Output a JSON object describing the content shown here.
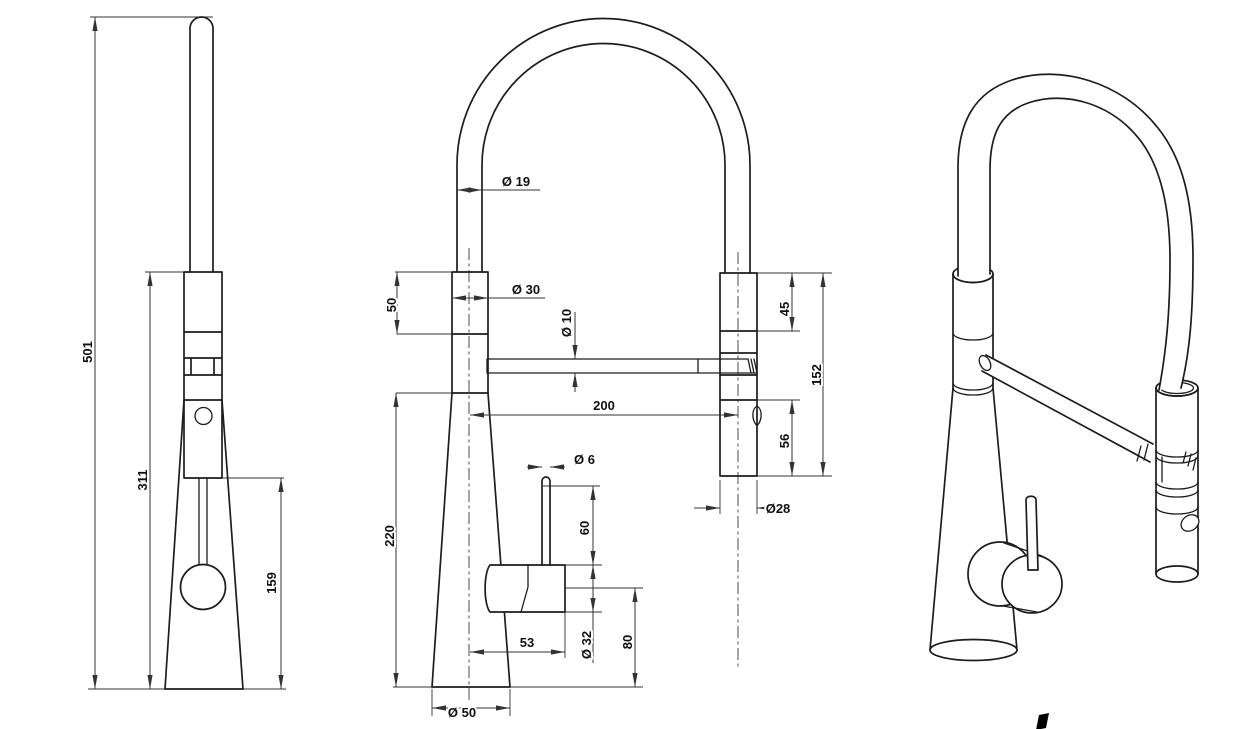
{
  "drawing": {
    "type": "technical-dimension-drawing",
    "subject": "kitchen faucet with pull-down spray head",
    "colors": {
      "line": "#1d1d1d",
      "dimension": "#333333",
      "background": "#ffffff",
      "logo_mark": "#000000"
    }
  },
  "dims": {
    "d501": "501",
    "d311": "311",
    "d159": "159",
    "d19": "Ø 19",
    "d30": "Ø 30",
    "d50": "50",
    "d10": "Ø 10",
    "d200": "200",
    "d45": "45",
    "d152": "152",
    "d56": "56",
    "d6": "Ø 6",
    "d60": "60",
    "d32": "Ø 32",
    "d80": "80",
    "d53": "53",
    "d28": "Ø28",
    "d220": "220",
    "d50b": "Ø 50"
  }
}
